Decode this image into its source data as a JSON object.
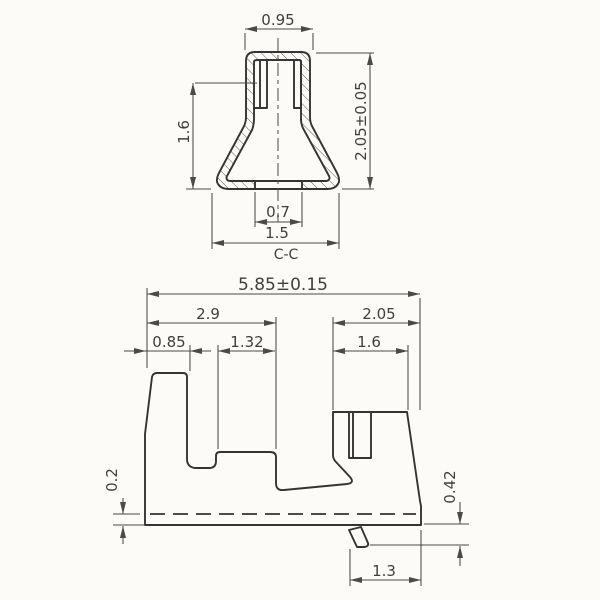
{
  "drawing": {
    "section_label": "C-C",
    "top_view": {
      "width_top": "0.95",
      "height_left": "1.6",
      "height_right": "2.05±0.05",
      "slot_width": "0.7",
      "base_width": "1.5"
    },
    "bottom_view": {
      "overall_width": "5.85±0.15",
      "left_span": "2.9",
      "right_span": "2.05",
      "tab_width": "0.85",
      "cavity_width": "1.32",
      "pocket_width": "1.6",
      "standoff": "0.2",
      "foot_height": "0.42",
      "foot_offset": "1.3"
    },
    "colors": {
      "line": "#343434",
      "dimension": "#4a4a4a",
      "background": "#fcfbf7"
    }
  }
}
